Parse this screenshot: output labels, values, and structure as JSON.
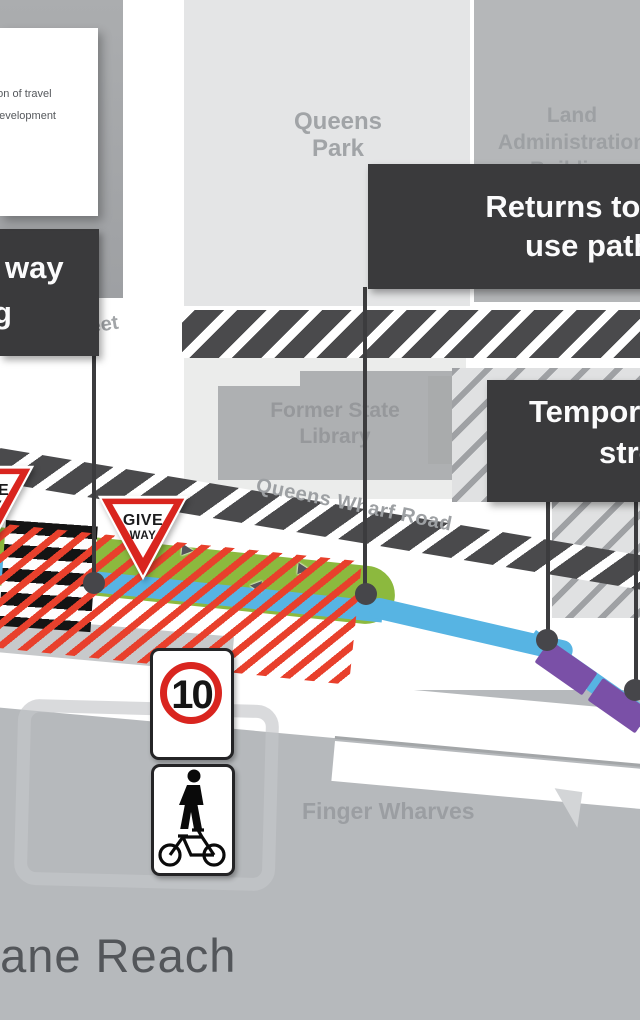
{
  "colors": {
    "green_path": "#8cb93e",
    "blue_path": "#57b4e3",
    "red_hatch": "#e8402c",
    "purple_dash": "#7a50a7",
    "callout_bg": "#3a3a3c",
    "river": "#b6b9bc",
    "sign_red": "#d9251f"
  },
  "legend": {
    "line1": "Direction of travel",
    "line2": "development"
  },
  "callouts": {
    "left": {
      "line1": "way",
      "line2": "g"
    },
    "returns": {
      "line1": "Returns to shared",
      "line2": "use pathway"
    },
    "temporary": {
      "line1": "Temporary",
      "line2": "street"
    }
  },
  "areas": {
    "queens_park": {
      "line1": "Queens",
      "line2": "Park"
    },
    "land_administration": {
      "line1": "Land",
      "line2": "Administration",
      "line3": "Building"
    },
    "former_state_library": {
      "line1": "Former State",
      "line2": "Library"
    },
    "finger_wharves": "Finger Wharves",
    "reach": "Brisbane Reach",
    "street_fragment": "Street",
    "road": "Queens Wharf Road"
  },
  "signs": {
    "give_way": {
      "line1": "GIVE",
      "line2": "WAY"
    },
    "speed_limit": "10"
  },
  "path": {
    "arrows": [
      "▶",
      "▶",
      "◀"
    ]
  }
}
